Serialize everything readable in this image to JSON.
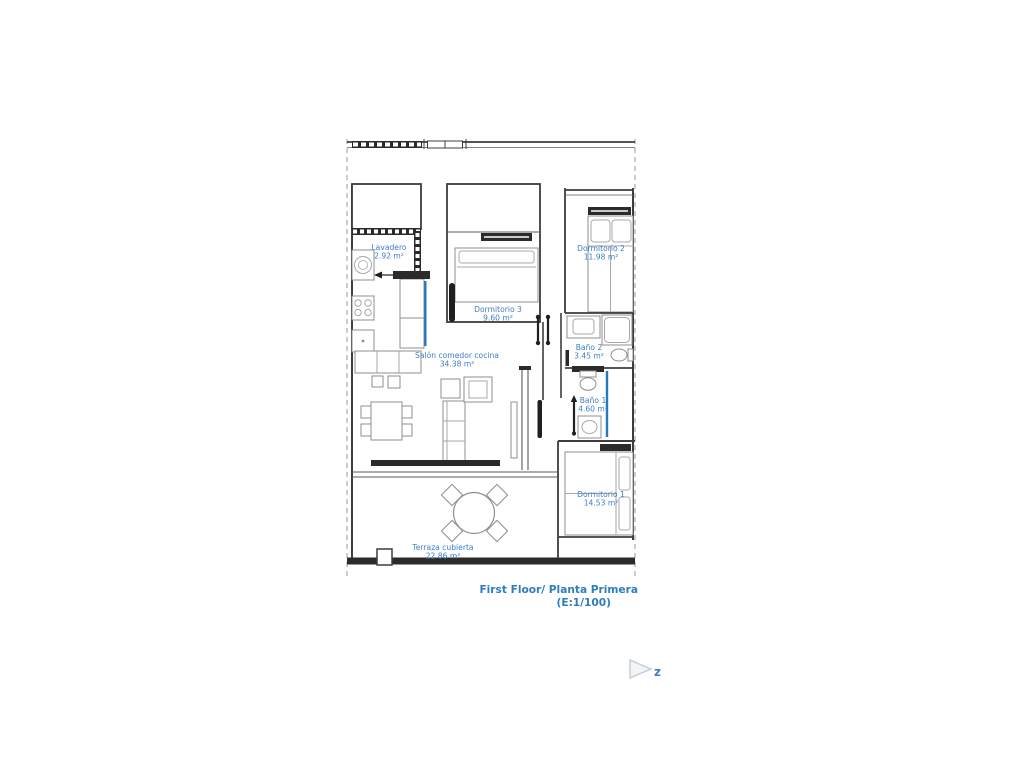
{
  "plan": {
    "rooms": [
      {
        "name": "Lavadero",
        "area": "2.92 m²"
      },
      {
        "name": "Dormitorio 3",
        "area": "9.60 m²"
      },
      {
        "name": "Dormitorio 2",
        "area": "11.98 m²"
      },
      {
        "name": "Baño 2",
        "area": "3.45 m²"
      },
      {
        "name": "Baño 1",
        "area": "4.60 m²"
      },
      {
        "name": "Salón comedor cocina",
        "area": "34.38 m²"
      },
      {
        "name": "Dormitorio 1",
        "area": "14.53 m²"
      },
      {
        "name": "Terraza cubierta",
        "area": "22.86 m²"
      }
    ],
    "title": {
      "line1": "First Floor/ Planta Primera",
      "line2": "(E:1/100)"
    },
    "watermark_letter": "z",
    "colors": {
      "label_blue": "#3e7ec5",
      "accent_blue": "#2878be",
      "wall_dark": "#3d3d3d"
    }
  }
}
